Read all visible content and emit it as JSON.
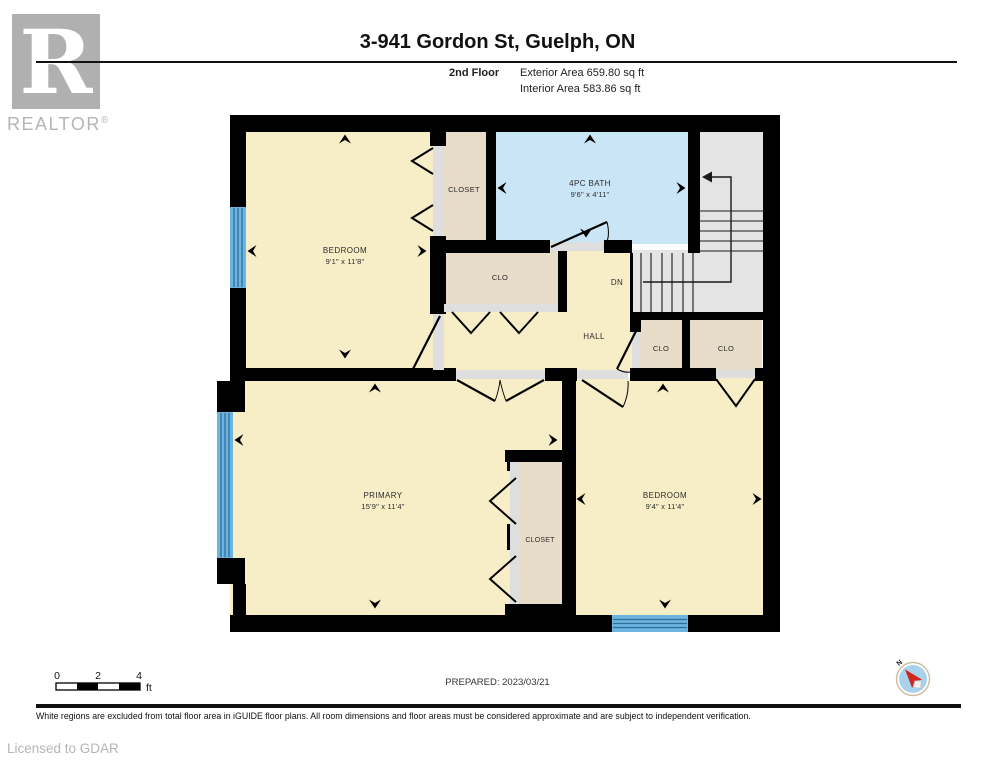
{
  "header": {
    "logo": {
      "letter": "R",
      "wordmark": "REALTOR",
      "registered": "®"
    },
    "title": "3-941 Gordon St, Guelph, ON",
    "floor_label": "2nd Floor",
    "exterior_area": "Exterior Area 659.80 sq ft",
    "interior_area": "Interior Area 583.86 sq ft"
  },
  "floor_plan": {
    "rooms": {
      "bedroom1": {
        "name": "BEDROOM",
        "dims": "9'1\" x 11'8\""
      },
      "closet1": {
        "name": "CLOSET"
      },
      "bath": {
        "name": "4PC BATH",
        "dims": "9'6\" x 4'11\""
      },
      "clo_hall": {
        "name": "CLO"
      },
      "stairs": {
        "name": "DN"
      },
      "hall": {
        "name": "HALL"
      },
      "clo_left": {
        "name": "CLO"
      },
      "clo_right": {
        "name": "CLO"
      },
      "primary": {
        "name": "PRIMARY",
        "dims": "15'9\" x 11'4\""
      },
      "closet_primary": {
        "name": "CLOSET"
      },
      "bedroom2": {
        "name": "BEDROOM",
        "dims": "9'4\" x 11'4\""
      }
    },
    "colors": {
      "room_fill": "#f7eec8",
      "closet_fill": "#e6dcc8",
      "bath_fill": "#cae5f5",
      "stairs_fill": "#e4e4e4",
      "window_fill": "#6db5e0",
      "wall": "#000000"
    }
  },
  "scale_bar": {
    "labels": [
      "0",
      "2",
      "4"
    ],
    "unit": "ft"
  },
  "prepared": "PREPARED: 2023/03/21",
  "compass": {
    "label": "N"
  },
  "footer": {
    "disclaimer": "White regions are excluded from total floor area in iGUIDE floor plans. All room dimensions and floor areas must be considered approximate and are subject to independent verification.",
    "license": "Licensed to GDAR"
  }
}
